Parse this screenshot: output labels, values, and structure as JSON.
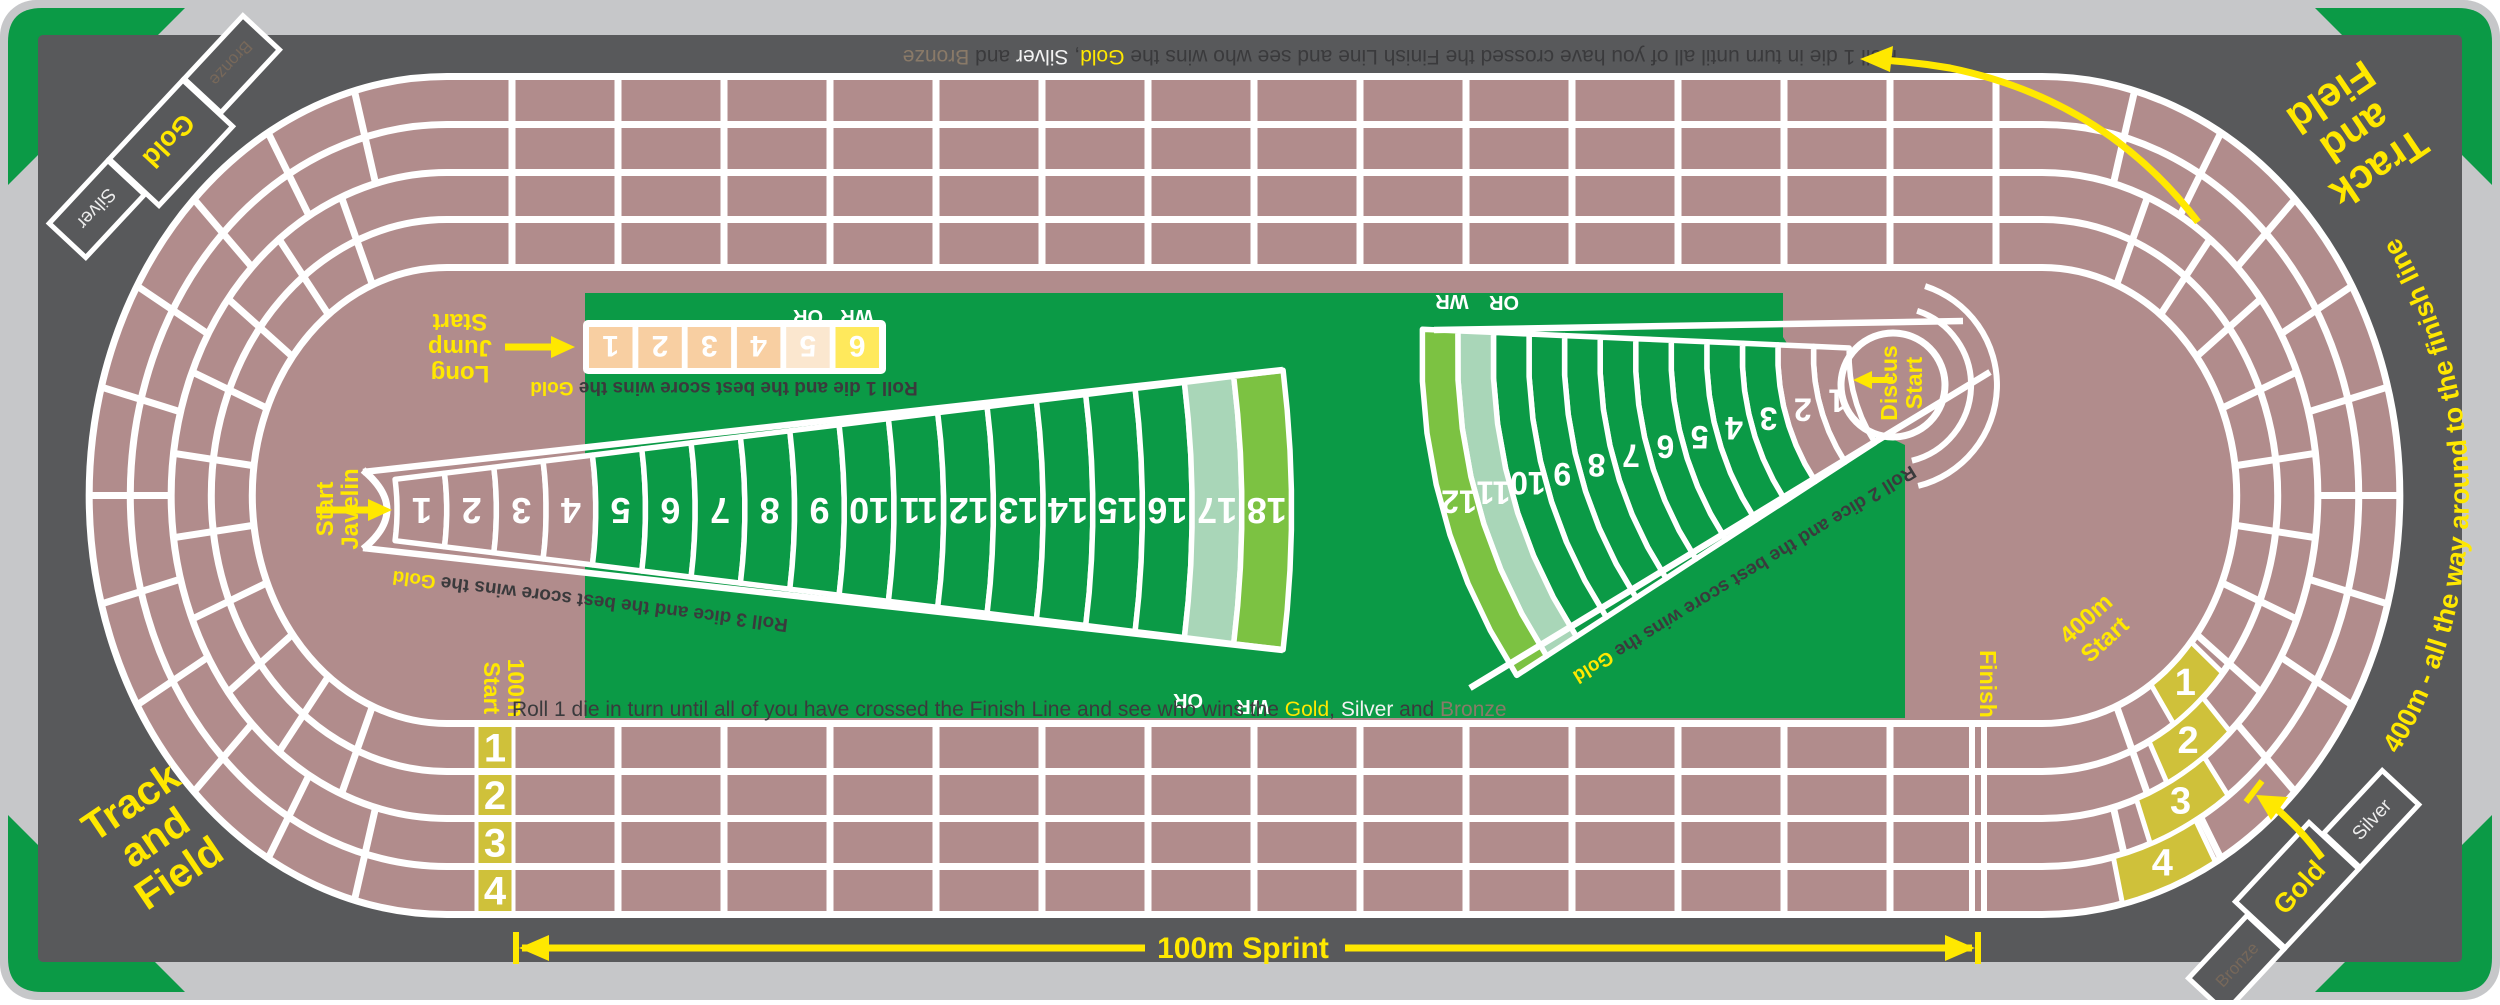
{
  "colors": {
    "mat": "#C6C7C9",
    "board": "#58595B",
    "green": "#0B9A46",
    "track": "#B18C8C",
    "white": "#FFFFFF",
    "gold_cell": "#CFC13A",
    "yellow": "#FFE800",
    "peach": "#F8CFA2",
    "peach_light": "#FBE7CF",
    "lj_six": "#FFE95C",
    "seafoam": "#A9D6B8",
    "lime": "#7CC242",
    "dark_text": "#3A3A3C",
    "bronze_text": "#8A7A68",
    "silver_text": "#F2F2F2",
    "podium_bronze": "#77685A",
    "podium_silver": "#ECECEC"
  },
  "corner_title": [
    "Track",
    "and",
    "Field"
  ],
  "instructions": {
    "sentence": [
      {
        "t": "Roll 1 die in turn until all of you have crossed the Finish Line and see who wins the ",
        "c": "dark"
      },
      {
        "t": "Gold",
        "c": "gold"
      },
      {
        "t": ", ",
        "c": "dark"
      },
      {
        "t": "Silver",
        "c": "silver"
      },
      {
        "t": " and ",
        "c": "dark"
      },
      {
        "t": "Bronze",
        "c": "bronze"
      }
    ]
  },
  "sprint": {
    "label": "100m Sprint",
    "start_label": [
      "100m",
      "Start"
    ],
    "lanes": [
      "1",
      "2",
      "3",
      "4"
    ],
    "finish_label": "Finish"
  },
  "lap400": {
    "label": [
      "400m",
      "Start"
    ],
    "cells": [
      "1",
      "2",
      "3",
      "4"
    ],
    "curve_text": "400m - all the way around to the finish line"
  },
  "long_jump": {
    "label": [
      "Long",
      "Jump",
      "Start"
    ],
    "cells": [
      "1",
      "2",
      "3",
      "4",
      "5",
      "6"
    ],
    "or": "OR",
    "wr": "WR",
    "caption": [
      {
        "t": "Roll 1 die and the best score wins the ",
        "c": "dark"
      },
      {
        "t": "Gold",
        "c": "gold"
      }
    ]
  },
  "javelin": {
    "label": [
      "Javelin",
      "Start"
    ],
    "count": 18,
    "or": "OR",
    "wr": "WR",
    "caption": [
      {
        "t": "Roll 3 dice and the best score wins the ",
        "c": "dark"
      },
      {
        "t": "Gold",
        "c": "gold"
      }
    ]
  },
  "discus": {
    "label": [
      "Discus",
      "Start"
    ],
    "count": 12,
    "or": "OR",
    "wr": "WR",
    "caption": [
      {
        "t": "Roll 2 dice and the best score wins the ",
        "c": "dark"
      },
      {
        "t": "Gold",
        "c": "gold"
      }
    ]
  },
  "podium": {
    "gold": "Gold",
    "silver": "Silver",
    "bronze": "Bronze"
  }
}
